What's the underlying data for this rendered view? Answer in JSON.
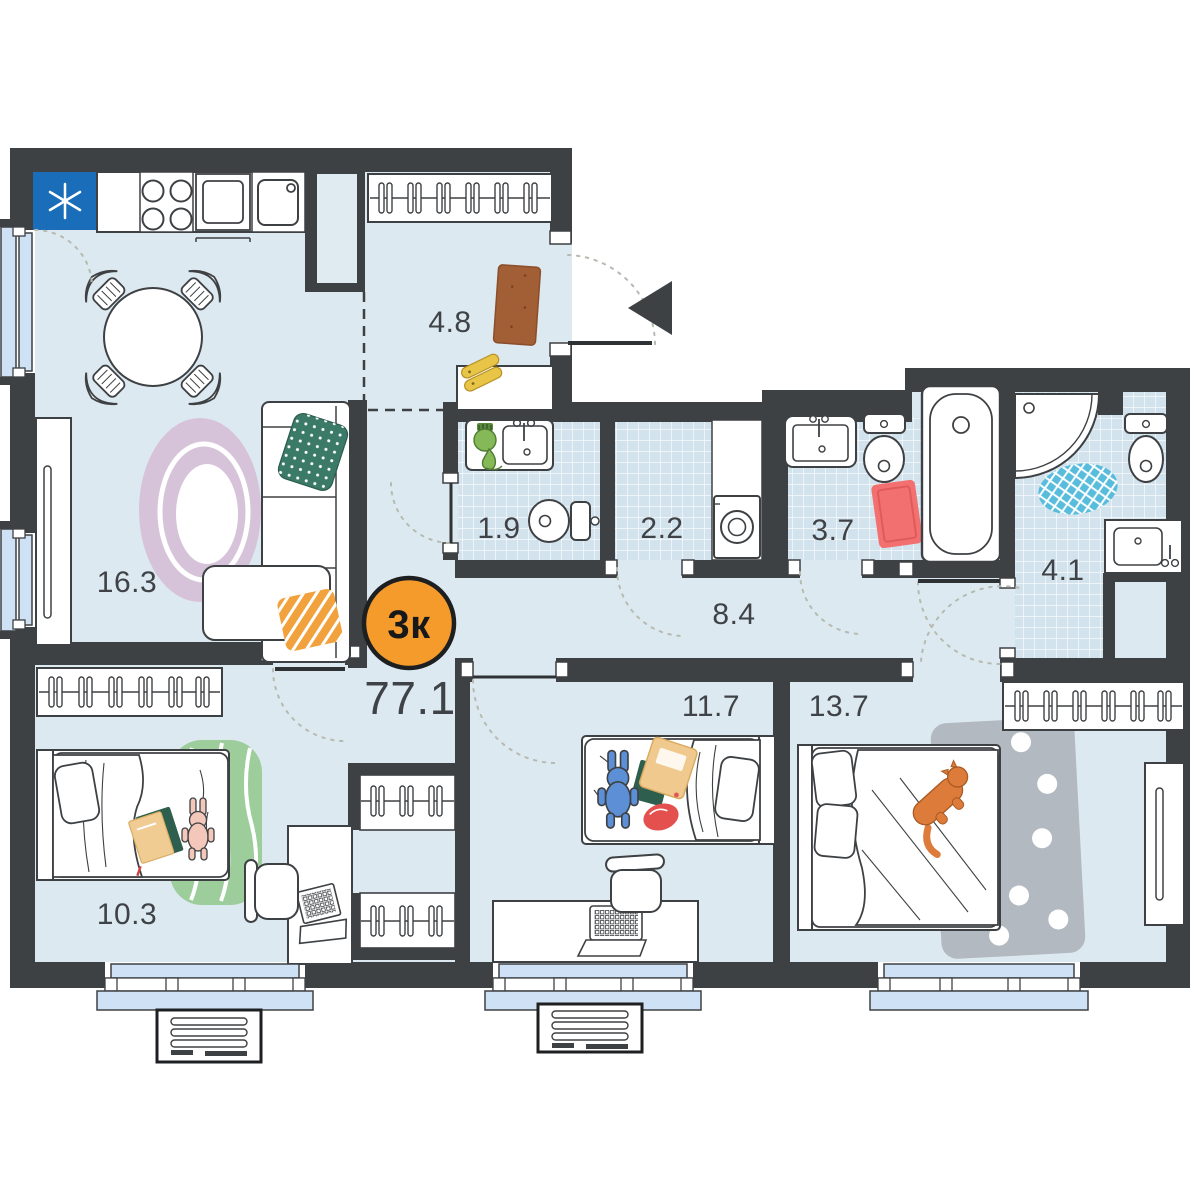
{
  "plan": {
    "badge": {
      "label": "3к"
    },
    "total_area": "77.1",
    "rooms": {
      "living_kitchen": {
        "area": "16.3"
      },
      "hallway": {
        "area": "4.8"
      },
      "bathroom_guest": {
        "area": "1.9"
      },
      "laundry": {
        "area": "2.2"
      },
      "bathroom_family": {
        "area": "3.7"
      },
      "shower_room": {
        "area": "4.1"
      },
      "corridor": {
        "area": "8.4"
      },
      "bedroom_small": {
        "area": "10.3"
      },
      "bedroom_middle": {
        "area": "11.7"
      },
      "bedroom_master": {
        "area": "13.7"
      }
    },
    "colors": {
      "wall": "#3e4144",
      "floor": "#dde9f0",
      "tile": "#d3e3ed",
      "badge_accent": "#f59b2b",
      "fridge_blue": "#1a6db8",
      "window_glass": "#cfe1f5",
      "rug_pink": "#d7c3d9",
      "rug_green": "#9ccd9b",
      "rug_gray": "#b2b9c0",
      "rug_red": "#f37070",
      "rug_blue": "#58bcdc",
      "rug_brown": "#a25f35",
      "pillow_green": "#3c7a68",
      "pillow_orange": "#f2a23c",
      "cat_orange": "#dc7b3a"
    }
  }
}
